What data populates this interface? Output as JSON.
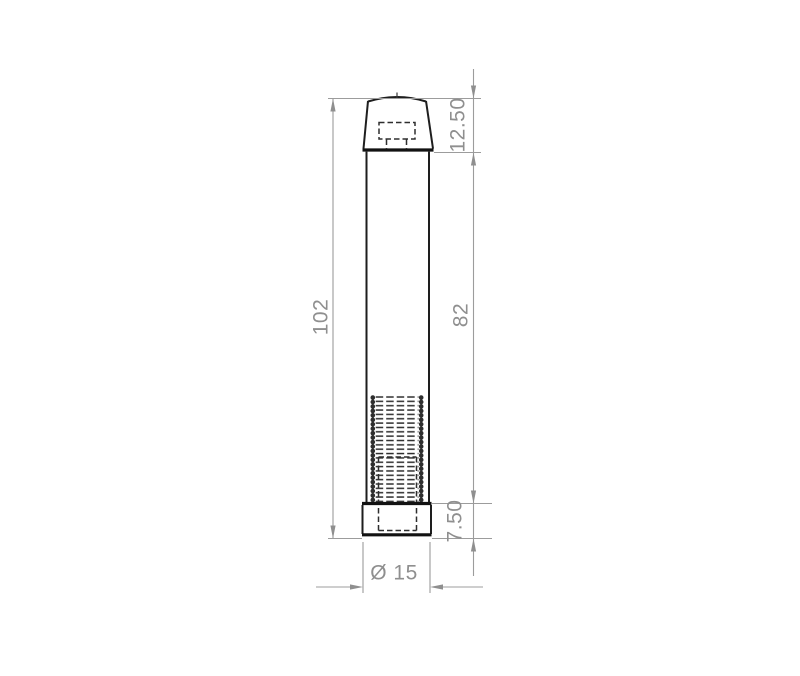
{
  "drawing": {
    "type": "technical-drawing",
    "labels": {
      "overall_height": "102",
      "body_height": "82",
      "cap_height": "12.50",
      "base_height": "7.50",
      "diameter": "Ø 15"
    },
    "style": {
      "background": "#ffffff",
      "outline_color": "#1e1e1e",
      "hidden_line_color": "#2e2e2e",
      "dimension_color": "#9c9c9c",
      "dimension_text_color": "#8f8f8f"
    }
  }
}
